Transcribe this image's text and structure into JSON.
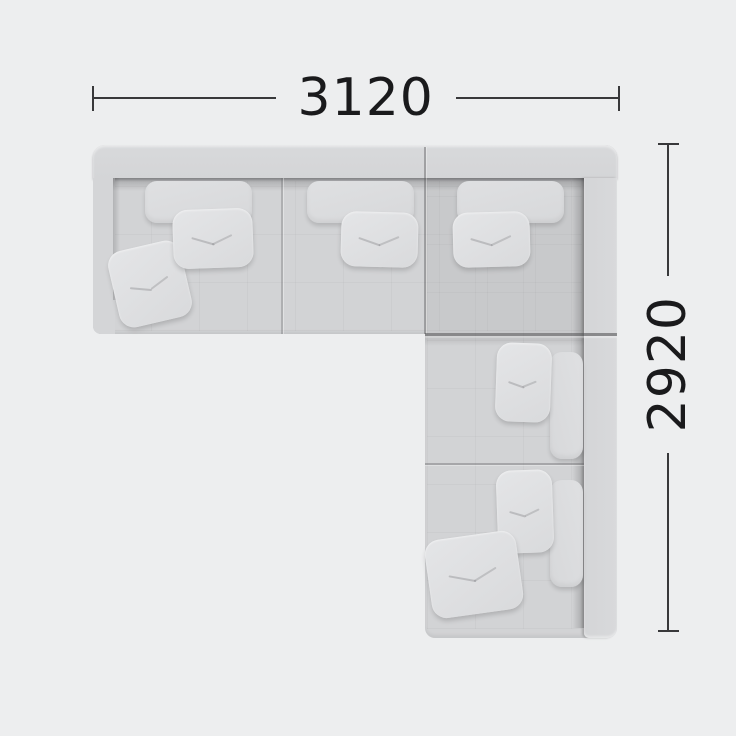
{
  "diagram": {
    "type": "corner-sofa-top-view-dimension-diagram",
    "background_color": "#EDEEEF",
    "sofa": {
      "body_color": "#D2D3D5",
      "backrest_color": "#D7D8DA",
      "cushion_color": "#E0E1E3",
      "seam_color": "#8E8E90",
      "modules": [
        "chaise-left",
        "seat-middle",
        "seat-corner",
        "seat-right-upper",
        "seat-right-lower"
      ],
      "headrest_count": 5,
      "pillow_count": 7
    }
  },
  "annotations": {
    "line_color": "#38383A",
    "text_color": "#1A1A1C",
    "width": {
      "label": "3120"
    },
    "height": {
      "label": "2920"
    }
  }
}
